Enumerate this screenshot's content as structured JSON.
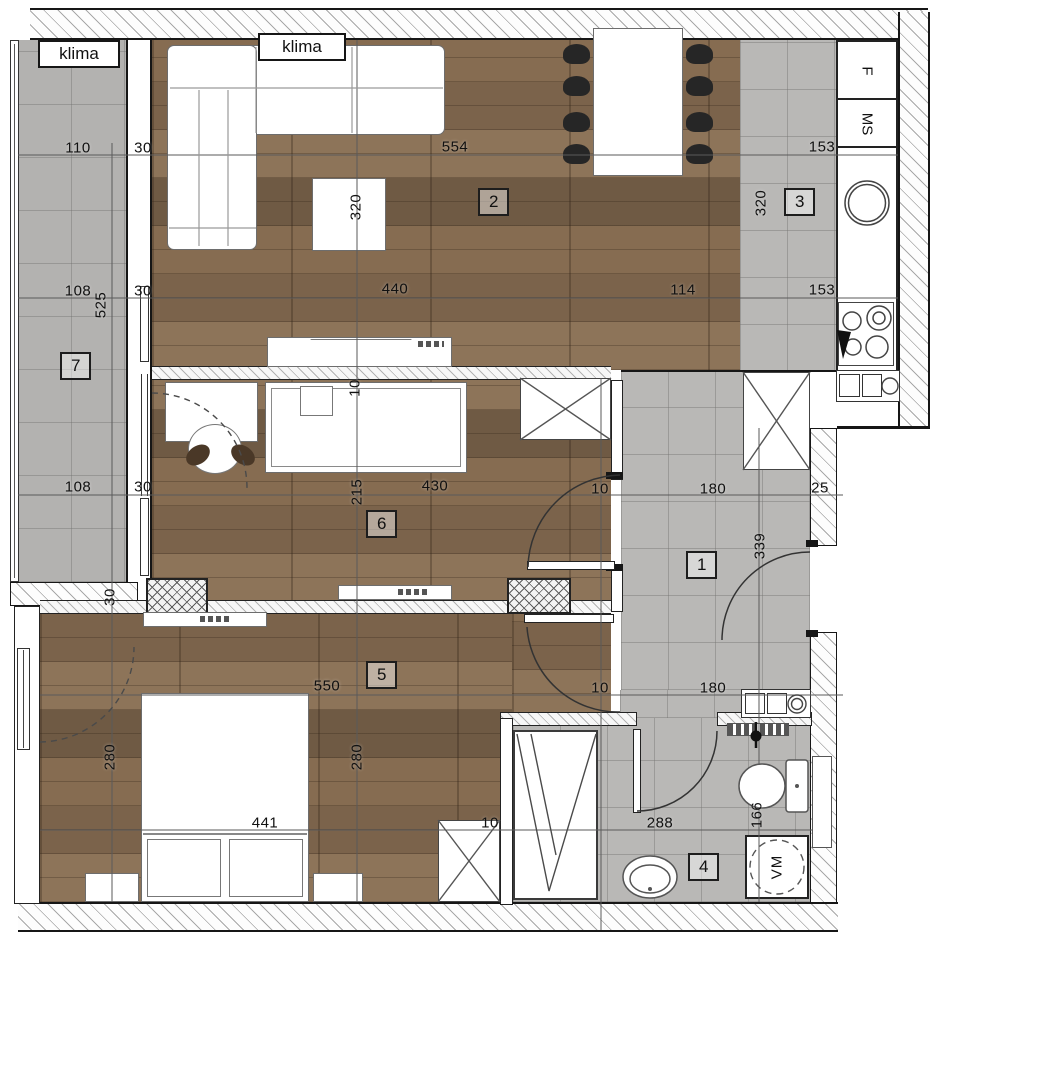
{
  "plan_type": "apartment-floor-plan",
  "colors": {
    "wood_floor": "#856b51",
    "tile_floor": "#b9b8b6",
    "wall_line": "#161616",
    "dimension_text": "#111111"
  },
  "rooms": [
    {
      "number": "1",
      "x": 686,
      "y": 551
    },
    {
      "number": "2",
      "x": 478,
      "y": 188
    },
    {
      "number": "3",
      "x": 784,
      "y": 188
    },
    {
      "number": "4",
      "x": 688,
      "y": 853
    },
    {
      "number": "5",
      "x": 366,
      "y": 661
    },
    {
      "number": "6",
      "x": 366,
      "y": 510
    },
    {
      "number": "7",
      "x": 60,
      "y": 352
    }
  ],
  "fixtures": {
    "klima_left": "klima",
    "klima_right": "klima",
    "fridge": "F",
    "ms_unit": "MS",
    "washing_machine": "VM"
  },
  "dimensions": [
    {
      "t": "110",
      "x": 78,
      "y": 148,
      "r": 0
    },
    {
      "t": "30",
      "x": 143,
      "y": 148,
      "r": 0
    },
    {
      "t": "554",
      "x": 455,
      "y": 147,
      "r": 0
    },
    {
      "t": "153",
      "x": 822,
      "y": 147,
      "r": 0
    },
    {
      "t": "108",
      "x": 78,
      "y": 291,
      "r": 0
    },
    {
      "t": "30",
      "x": 143,
      "y": 291,
      "r": 0
    },
    {
      "t": "440",
      "x": 395,
      "y": 289,
      "r": 0
    },
    {
      "t": "114",
      "x": 683,
      "y": 290,
      "r": 0
    },
    {
      "t": "153",
      "x": 822,
      "y": 290,
      "r": 0
    },
    {
      "t": "320",
      "x": 356,
      "y": 207,
      "r": -90
    },
    {
      "t": "320",
      "x": 761,
      "y": 203,
      "r": -90
    },
    {
      "t": "525",
      "x": 101,
      "y": 305,
      "r": -90
    },
    {
      "t": "108",
      "x": 78,
      "y": 487,
      "r": 0
    },
    {
      "t": "30",
      "x": 143,
      "y": 487,
      "r": 0
    },
    {
      "t": "430",
      "x": 435,
      "y": 486,
      "r": 0
    },
    {
      "t": "215",
      "x": 357,
      "y": 492,
      "r": -90
    },
    {
      "t": "10",
      "x": 600,
      "y": 489,
      "r": 0
    },
    {
      "t": "180",
      "x": 713,
      "y": 489,
      "r": 0
    },
    {
      "t": "25",
      "x": 820,
      "y": 488,
      "r": 0
    },
    {
      "t": "339",
      "x": 760,
      "y": 546,
      "r": -90
    },
    {
      "t": "10",
      "x": 355,
      "y": 388,
      "r": -90
    },
    {
      "t": "30",
      "x": 110,
      "y": 597,
      "r": -90
    },
    {
      "t": "550",
      "x": 327,
      "y": 686,
      "r": 0
    },
    {
      "t": "10",
      "x": 600,
      "y": 688,
      "r": 0
    },
    {
      "t": "180",
      "x": 713,
      "y": 688,
      "r": 0
    },
    {
      "t": "280",
      "x": 110,
      "y": 757,
      "r": -90
    },
    {
      "t": "280",
      "x": 357,
      "y": 757,
      "r": -90
    },
    {
      "t": "441",
      "x": 265,
      "y": 823,
      "r": 0
    },
    {
      "t": "10",
      "x": 490,
      "y": 823,
      "r": 0
    },
    {
      "t": "288",
      "x": 660,
      "y": 823,
      "r": 0
    },
    {
      "t": "166",
      "x": 757,
      "y": 815,
      "r": -90
    }
  ]
}
